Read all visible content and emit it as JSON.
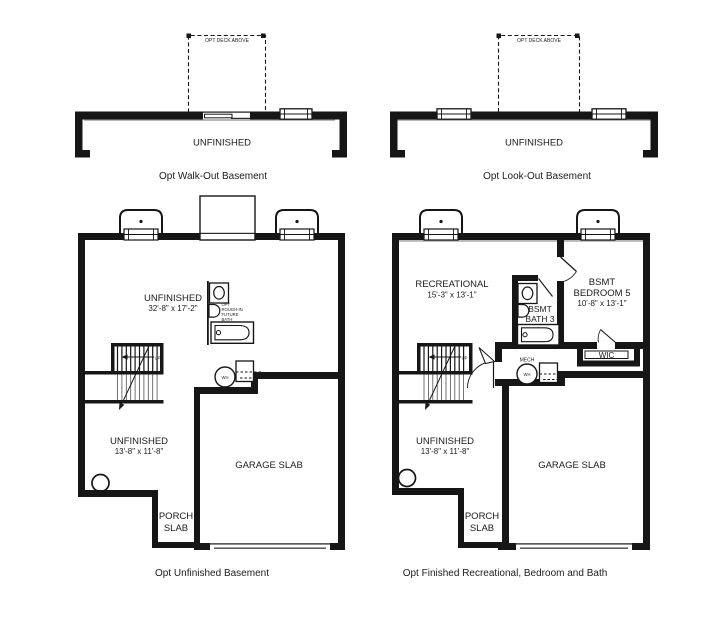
{
  "page": {
    "background": "#ffffff",
    "ink": "#161616",
    "muted_line": "#9a9a9a"
  },
  "plan_walkout": {
    "deck_label": "OPT DECK ABOVE",
    "room": "UNFINISHED",
    "caption": "Opt Walk-Out Basement"
  },
  "plan_lookout": {
    "deck_label": "OPT DECK ABOVE",
    "room": "UNFINISHED",
    "caption": "Opt Look-Out Basement"
  },
  "plan_unfinished": {
    "caption": "Opt Unfinished Basement",
    "main_room": "UNFINISHED",
    "main_dims": "32'-8\" x 17'-2\"",
    "rough_in": [
      "OPT",
      "ROUGH-IN",
      "FUTURE",
      "BATH"
    ],
    "lower_room": "UNFINISHED",
    "lower_dims": "13'-8\" x 11'-8\"",
    "garage": "GARAGE SLAB",
    "porch": [
      "PORCH",
      "SLAB"
    ],
    "water_heater": "WH",
    "up": "UP"
  },
  "plan_finished": {
    "caption": "Opt Finished Recreational, Bedroom and Bath",
    "rec_room": "RECREATIONAL",
    "rec_dims": "15'-3\" x 13'-1\"",
    "bedroom": [
      "BSMT",
      "BEDROOM 5"
    ],
    "bedroom_dims": "10'-8\" x 13'-1\"",
    "bath": [
      "BSMT",
      "BATH 3"
    ],
    "wic": "WIC",
    "mech": "MECH",
    "lower_room": "UNFINISHED",
    "lower_dims": "13'-8\" x 11'-8\"",
    "garage": "GARAGE SLAB",
    "porch": [
      "PORCH",
      "SLAB"
    ],
    "water_heater": "WH",
    "up": "UP"
  }
}
